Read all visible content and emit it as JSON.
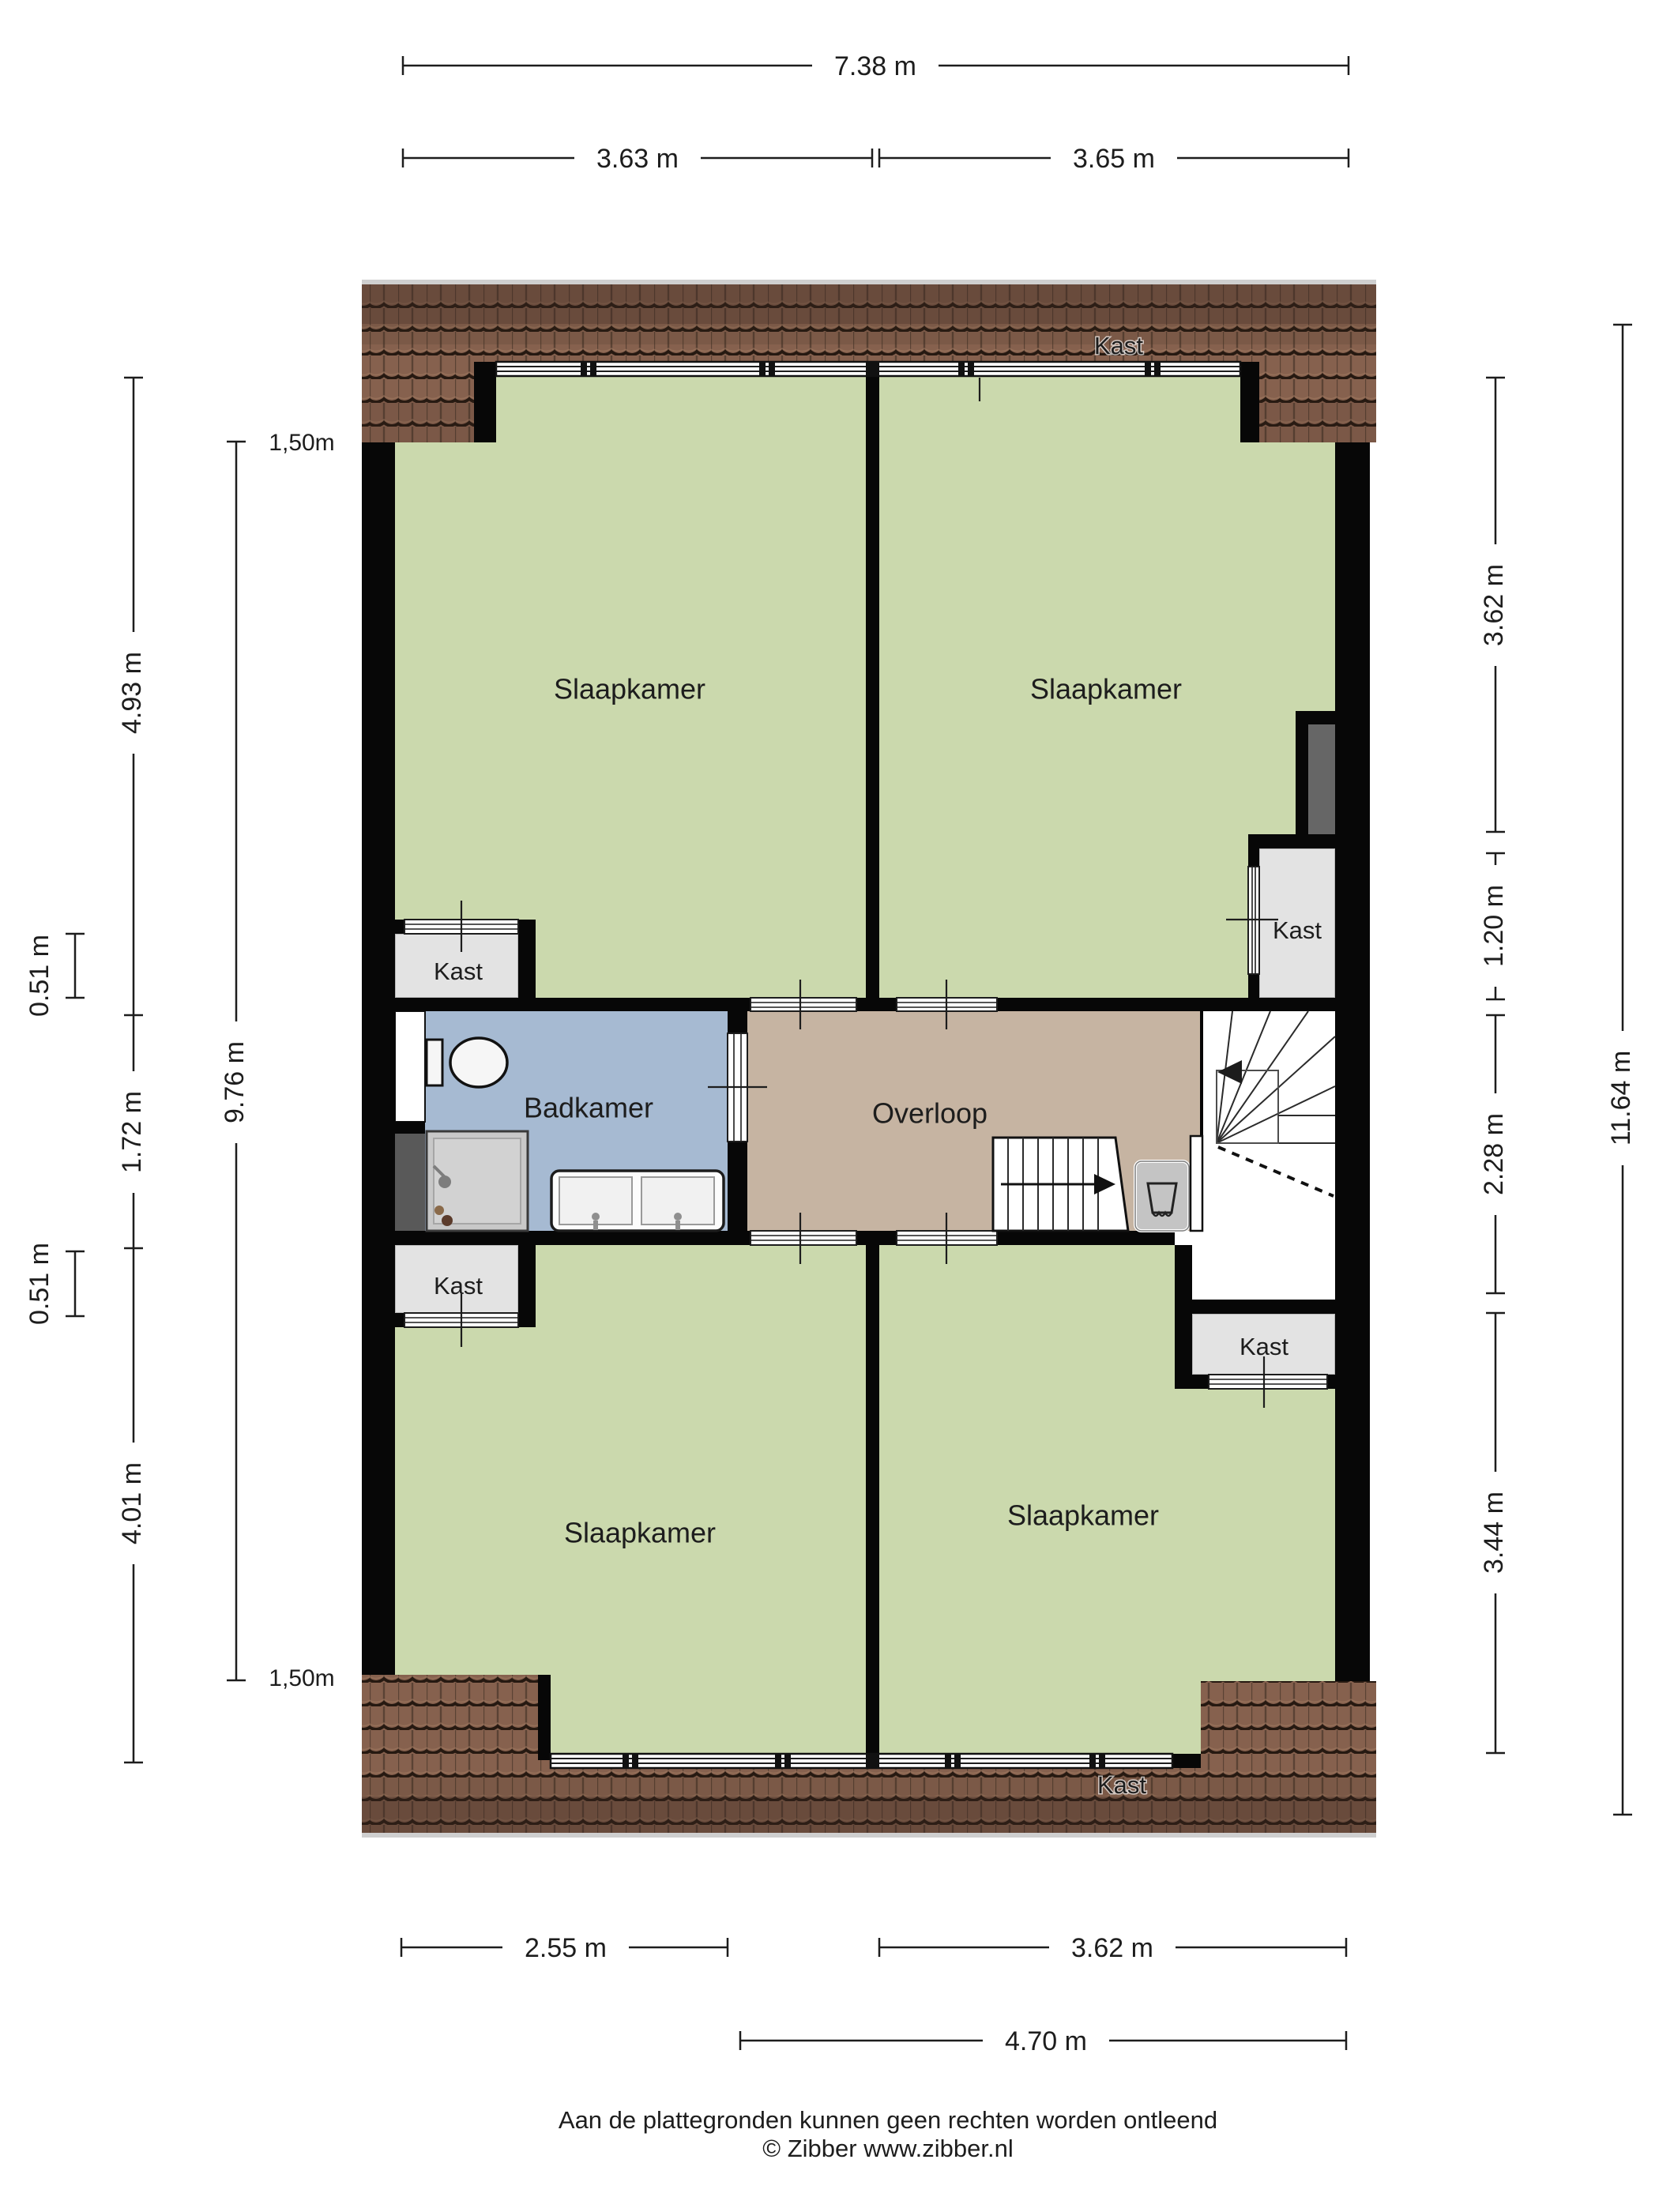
{
  "rooms": [
    {
      "id": "slaapkamer-tl",
      "label": "Slaapkamer"
    },
    {
      "id": "slaapkamer-tr",
      "label": "Slaapkamer"
    },
    {
      "id": "badkamer",
      "label": "Badkamer"
    },
    {
      "id": "overloop",
      "label": "Overloop"
    },
    {
      "id": "slaapkamer-bl",
      "label": "Slaapkamer"
    },
    {
      "id": "slaapkamer-br",
      "label": "Slaapkamer"
    }
  ],
  "closets": {
    "roof_top": "Kast",
    "left_upper": "Kast",
    "left_lower": "Kast",
    "right_upper": "Kast",
    "right_lower": "Kast",
    "roof_bottom": "Kast"
  },
  "dimensions": {
    "top": {
      "total": "7.38 m",
      "left": "3.63 m",
      "right": "3.65 m"
    },
    "left": {
      "knee_top": "1,50m",
      "knee_bottom": "1,50m",
      "seg_top": "4.93 m",
      "closet_top": "0.51 m",
      "seg_mid": "1.72 m",
      "closet_bottom": "0.51 m",
      "seg_bottom": "4.01 m",
      "inner_total": "9.76 m"
    },
    "right": {
      "seg1": "3.62 m",
      "seg2": "1.20 m",
      "seg3": "2.28 m",
      "seg4": "3.44 m",
      "total": "11.64 m"
    },
    "bottom": {
      "left": "2.55 m",
      "right": "3.62 m",
      "total": "4.70 m"
    }
  },
  "footer": {
    "line1": "Aan de plattegronden kunnen geen rechten worden ontleend",
    "line2": "© Zibber www.zibber.nl"
  },
  "colors": {
    "ink": "#1d1d1d",
    "wall": "#070707",
    "green": "#cbd9ad",
    "blue": "#a6bad2",
    "tan": "#c6b4a2",
    "kastgray": "#e3e3e3",
    "notch": "#666666",
    "duct": "#595959",
    "shower": "#c8c8c8",
    "rooftile": "#86614e",
    "roofdark": "#3a281f",
    "white": "#ffffff"
  }
}
